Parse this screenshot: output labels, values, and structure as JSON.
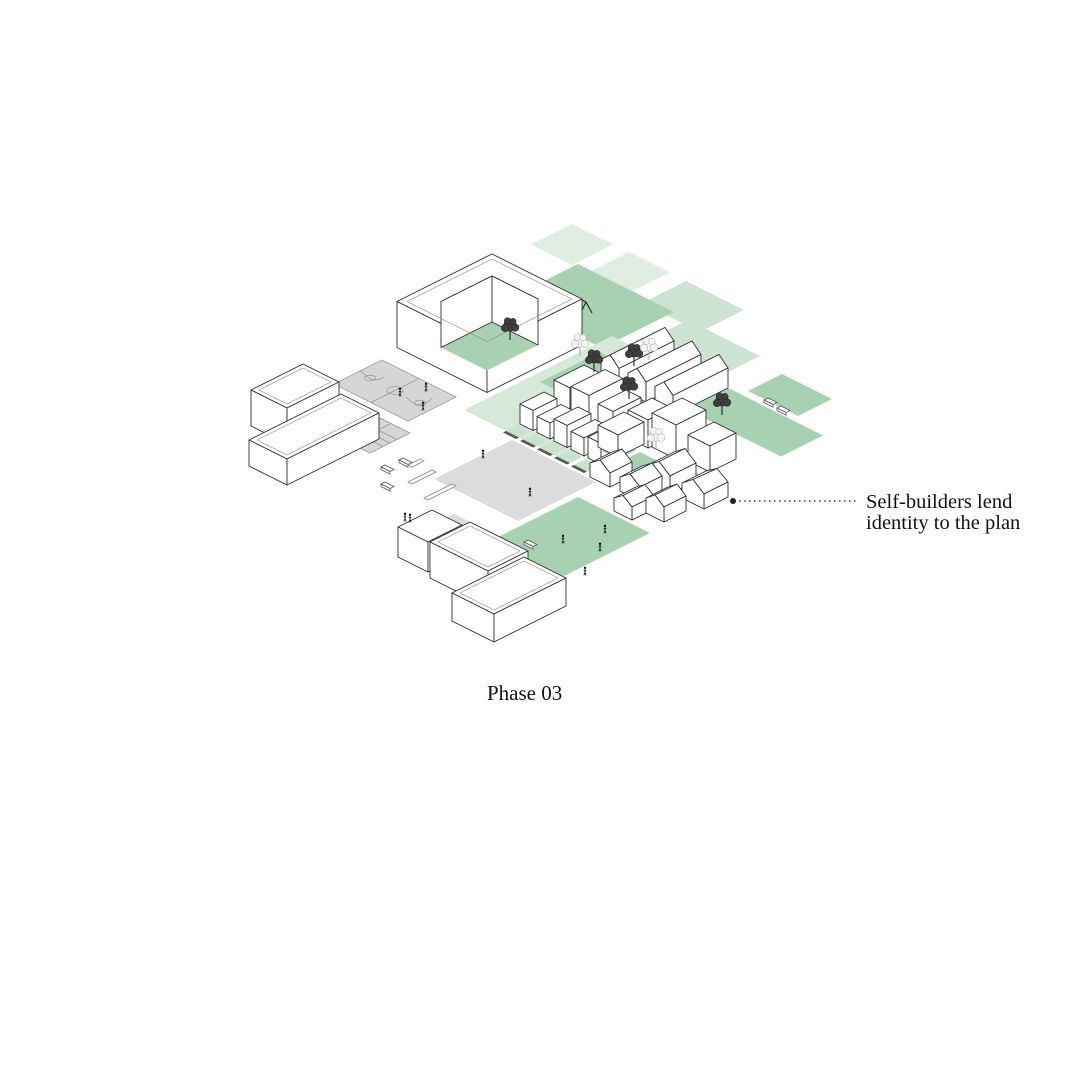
{
  "page": {
    "background": "#ffffff"
  },
  "caption": {
    "text": "Phase 03"
  },
  "annotation": {
    "line1": "Self-builders lend",
    "line2": "identity to the plan"
  },
  "colors": {
    "outline": "#2f2f2f",
    "green_pale": "#dfeee1",
    "green_soft": "#cde4d2",
    "green_light": "#c8e2cd",
    "green_field": "#d6e9d9",
    "green_med": "#a7d1b1",
    "gray_plaza": "#dcdcdc",
    "gray_court": "#d6d6d6",
    "court_line": "#9c9c9c",
    "wall_dark": "#575757",
    "leader": "#222222",
    "text": "#111111"
  }
}
